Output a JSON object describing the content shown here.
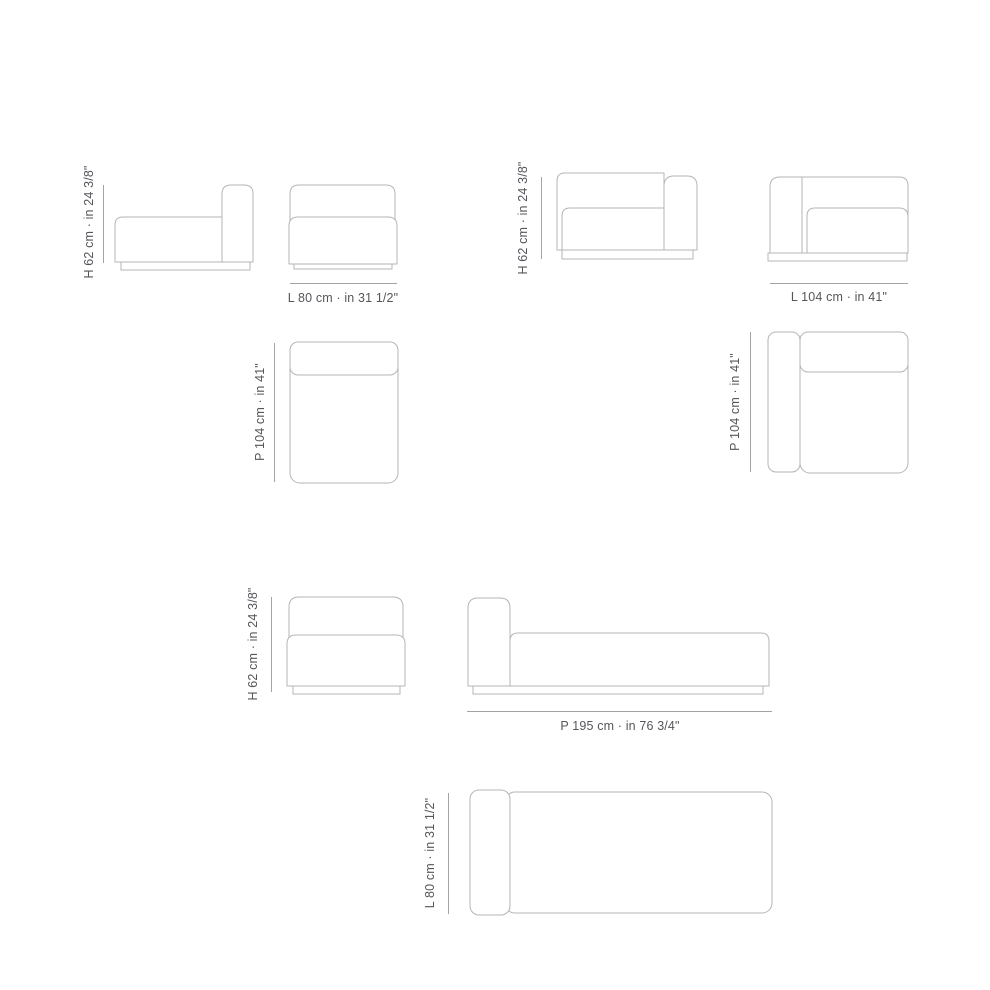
{
  "page": {
    "background": "#ffffff"
  },
  "colors": {
    "outline": "#b5b5b5",
    "dimension_line": "#a3a3a3",
    "label_text": "#54565b"
  },
  "sections": {
    "module_80": {
      "side_view_height_label": "H 62 cm · in 24 3/8\"",
      "front_view_width_label": "L 80 cm · in 31 1/2\"",
      "top_view_depth_label": "P 104 cm · in 41\""
    },
    "module_104": {
      "side_view_height_label": "H 62 cm · in 24 3/8\"",
      "front_view_width_label": "L 104 cm · in 41\"",
      "top_view_depth_label": "P 104 cm · in 41\""
    },
    "chaise_195": {
      "front_view_height_label": "H 62 cm · in 24 3/8\"",
      "side_view_depth_label": "P 195 cm · in 76 3/4\"",
      "top_view_width_label": "L 80 cm · in 31 1/2\""
    }
  }
}
